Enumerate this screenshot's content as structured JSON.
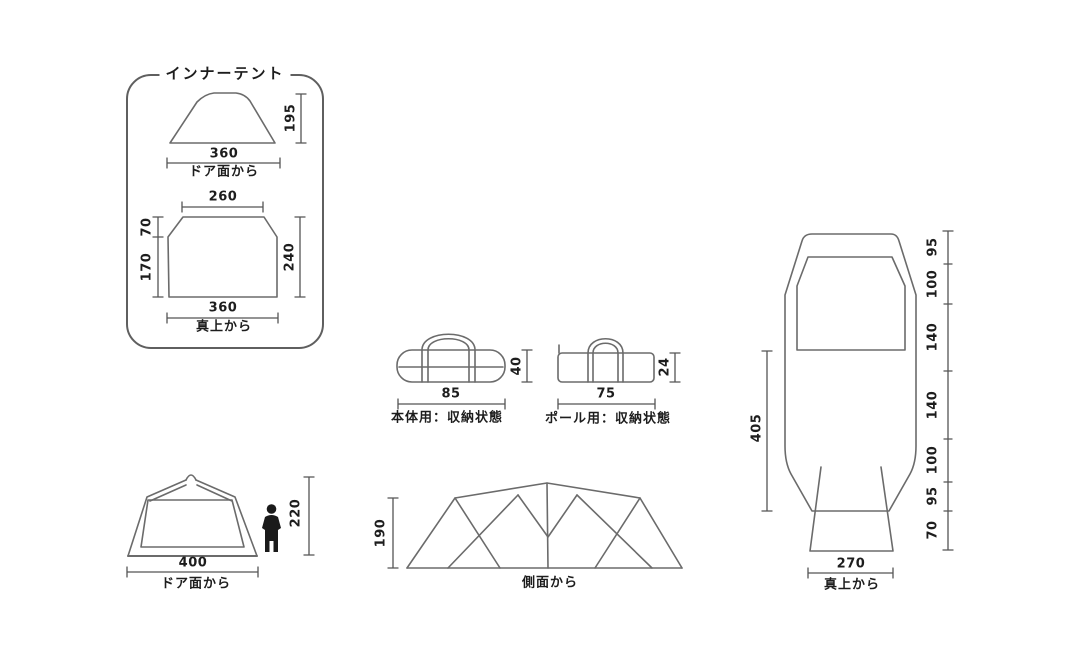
{
  "inner_tent_panel": {
    "title": "インナーテント",
    "front_view": {
      "height": "195",
      "width": "360",
      "caption": "ドア面から"
    },
    "top_view": {
      "top_width": "260",
      "corner_depth": "70",
      "side_lower": "170",
      "depth": "240",
      "width": "360",
      "caption": "真上から"
    }
  },
  "storage_bags": {
    "body_bag": {
      "width": "85",
      "height": "40",
      "caption": "本体用：収納状態"
    },
    "pole_bag": {
      "width": "75",
      "height": "24",
      "caption": "ポール用：収納状態"
    }
  },
  "door_view": {
    "width": "400",
    "height": "220",
    "caption": "ドア面から"
  },
  "side_view": {
    "height": "190",
    "caption": "側面から"
  },
  "overhead_view": {
    "length": "405",
    "width": "270",
    "caption": "真上から",
    "segments": [
      "95",
      "100",
      "140",
      "140",
      "100",
      "95",
      "70"
    ]
  },
  "colors": {
    "line": "#6b6b6b",
    "dim_line": "#555555",
    "text": "#1d1d1d",
    "background": "#ffffff"
  }
}
